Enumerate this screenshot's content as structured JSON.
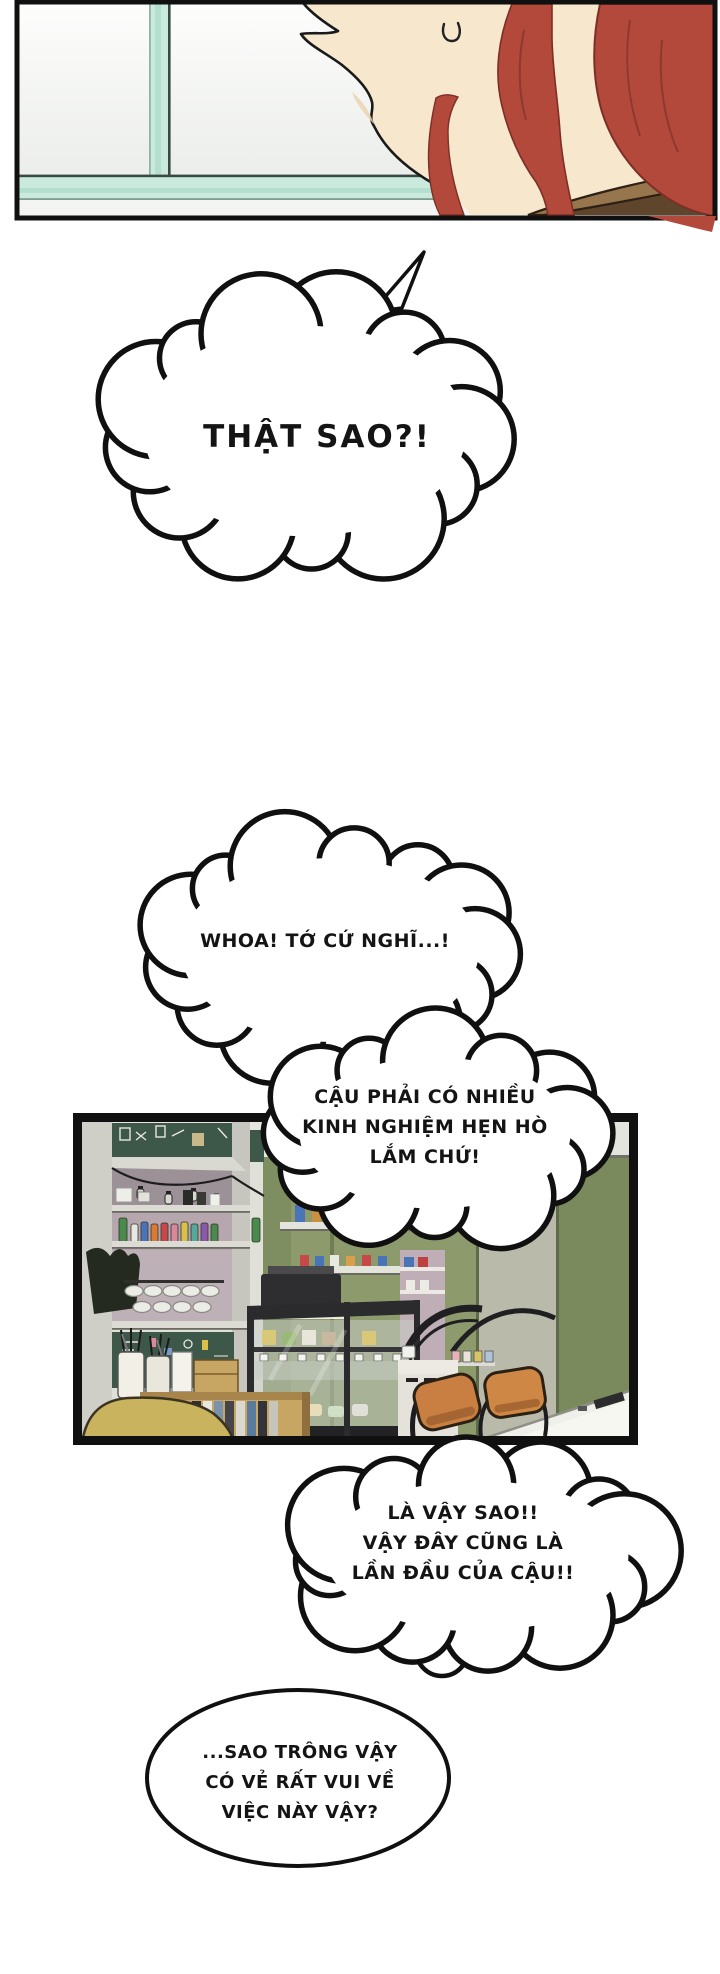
{
  "page": {
    "type_label": "webtoon comic page",
    "background": "#ffffff"
  },
  "panels": {
    "window_closeup": {
      "alt": "close-up of red-haired character in profile at a window, sweat drop on cheek"
    },
    "cafe_interior": {
      "alt": "cafe counter with shelves, chalkboards, bottles, display cases, chairs and table"
    }
  },
  "bubbles": {
    "b1": {
      "text": "THẬT SAO?!"
    },
    "b2": {
      "text": "WHOA! TỚ CỨ NGHĨ...!"
    },
    "b3": {
      "line1": "CẬU PHẢI CÓ NHIỀU",
      "line2": "KINH NGHIỆM HẸN HÒ",
      "line3": "LẮM CHỨ!"
    },
    "b4": {
      "line1": "LÀ VẬY SAO!!",
      "line2": "VẬY ĐÂY CŨNG LÀ",
      "line3": "LẦN ĐẦU CỦA CẬU!!"
    },
    "b5": {
      "line1": "...SAO TRÔNG VẬY",
      "line2": "CÓ VẺ RẤT VUI VỀ",
      "line3": "VIỆC NÀY VẬY?"
    }
  },
  "colors": {
    "panel_border": "#101010",
    "speech_text": "#141414",
    "hair": "#b3493a",
    "hair_dark": "#7d2f26",
    "skin": "#f6e7cd",
    "window_mint": "#c9eadd",
    "chalkboard_green": "#3d5748",
    "wall_olive": "#8d9a6c",
    "wall_olive_dark": "#7b8a5c",
    "wall_gray_green": "#b9baa9",
    "chair_orange": "#c97f41",
    "chair_yellow": "#c9b35e",
    "wood_tan": "#c7a563",
    "case_dark": "#2b2b2e",
    "collar_brown": "#97764e"
  }
}
